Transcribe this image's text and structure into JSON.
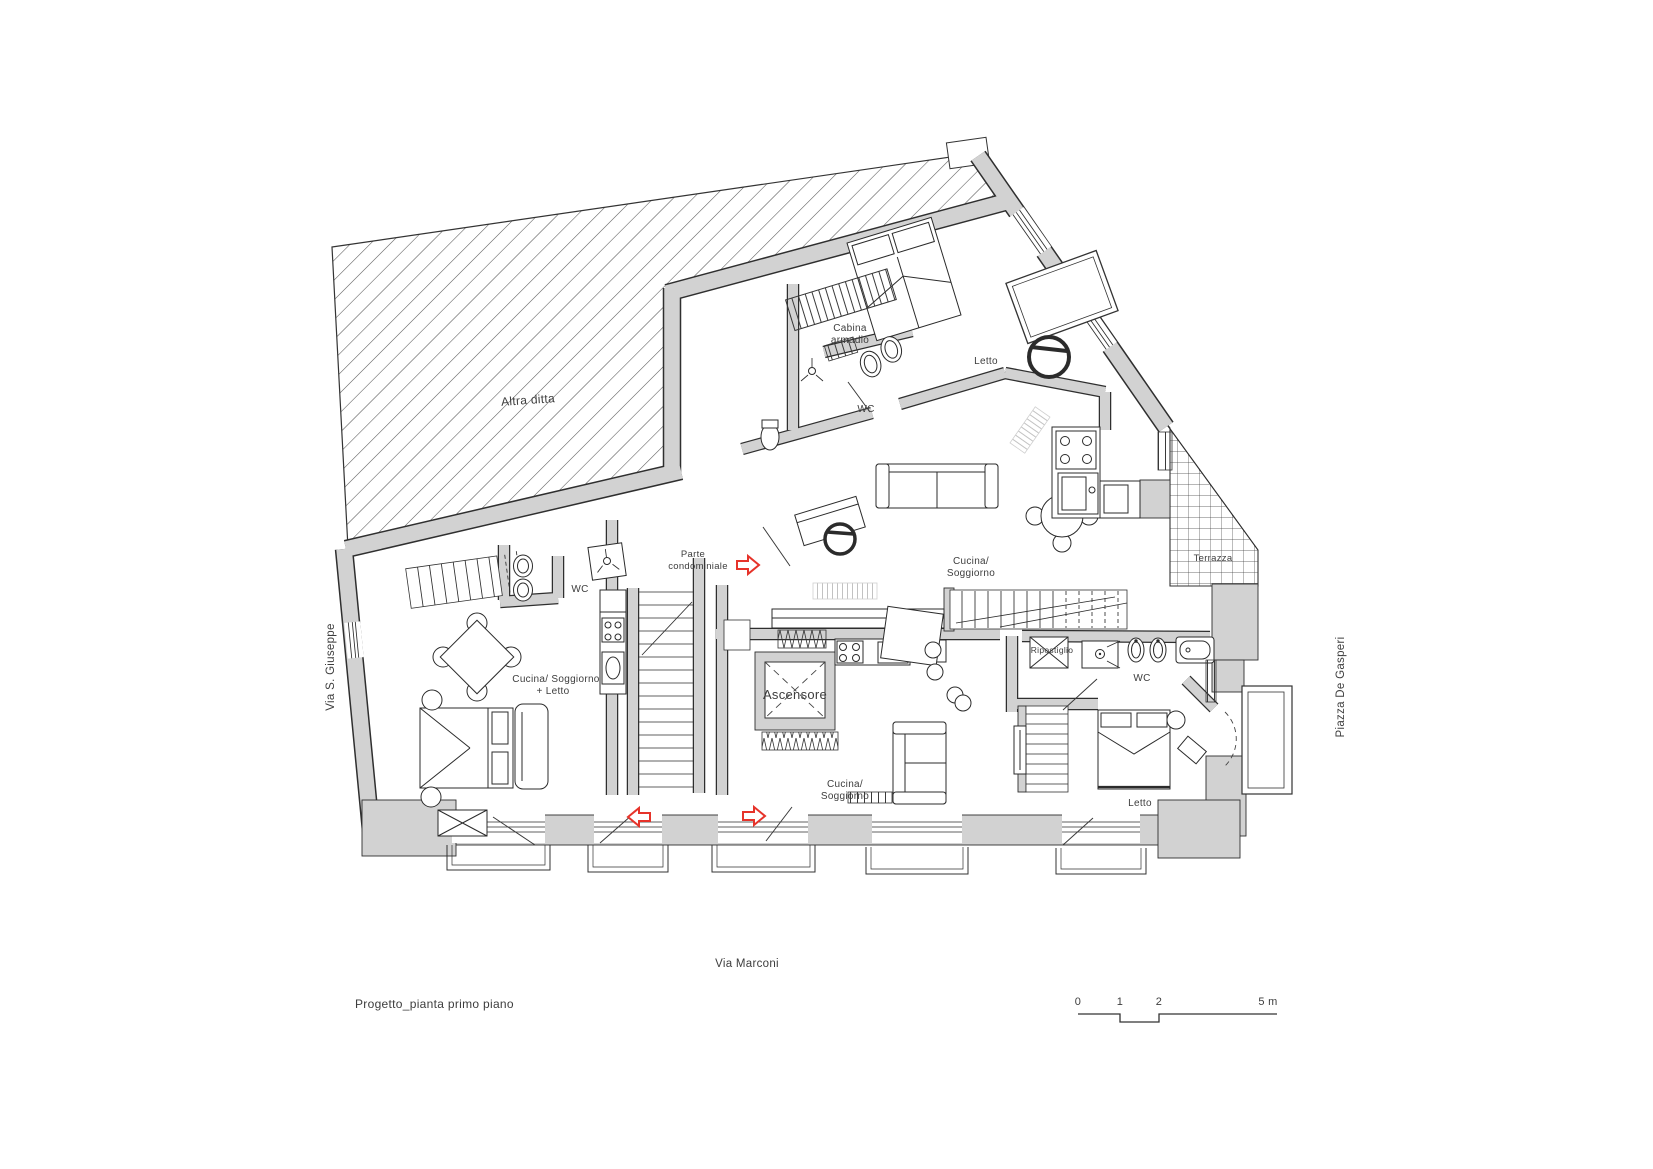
{
  "drawing": {
    "title": "Progetto_pianta primo piano",
    "streets": {
      "left": "Via S. Giuseppe",
      "bottom": "Via Marconi",
      "right": "Piazza De Gasperi"
    },
    "scale_bar": {
      "t0": "0",
      "t1": "1",
      "t2": "2",
      "t5": "5 m"
    },
    "colors": {
      "wall": "#d2d2d2",
      "line": "#2f2f2f",
      "red": "#e6332a",
      "text": "#3d3d3d",
      "muted": "#8f8f8f"
    },
    "rooms": {
      "altra_ditta": "Altra ditta",
      "cabina_l1": "Cabina",
      "cabina_l2": "armadio",
      "letto_ne": "Letto",
      "wc_ne": "WC",
      "parte_l1": "Parte",
      "parte_l2": "condominiale",
      "wc_w": "WC",
      "cucina_e_l1": "Cucina/",
      "cucina_e_l2": "Soggiorno",
      "cucina_w_l1": "Cucina/ Soggiorno",
      "cucina_w_l2": "+ Letto",
      "ascensore": "Ascensore",
      "cucina_s_l1": "Cucina/",
      "cucina_s_l2": "Soggiorno",
      "ripostiglio": "Ripostiglio",
      "wc_e": "WC",
      "letto_se": "Letto",
      "terrazza": "Terrazza"
    }
  }
}
